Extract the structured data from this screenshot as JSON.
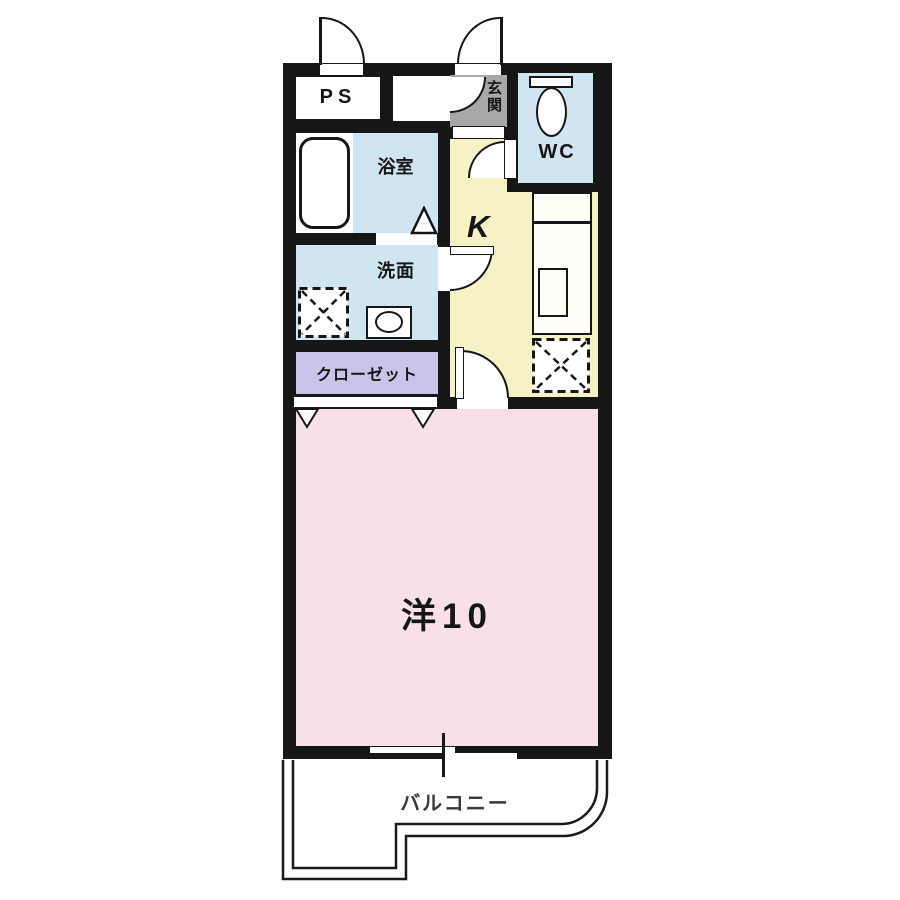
{
  "rooms": {
    "ps": "PS",
    "entrance": "玄関",
    "wc": "WC",
    "bathroom": "浴室",
    "kitchen": "K",
    "washroom": "洗面",
    "closet": "クローゼット",
    "western_room": "洋10",
    "balcony": "バルコニー"
  },
  "colors": {
    "wall": "#161616",
    "wet_rooms": "#d0e5f2",
    "kitchen": "#f7f2c6",
    "western_room": "#f8dfe9",
    "closet": "#c9c5ea",
    "entrance": "#a8a8a8",
    "balcony": "#ffffff"
  },
  "fixtures": [
    "bathtub",
    "toilet",
    "wash-basin",
    "washing-machine-space",
    "kitchen-counter",
    "kitchen-sink",
    "refrigerator-space",
    "hinged-doors",
    "closet-sliding-door",
    "sliding-window",
    "balcony-railing"
  ]
}
